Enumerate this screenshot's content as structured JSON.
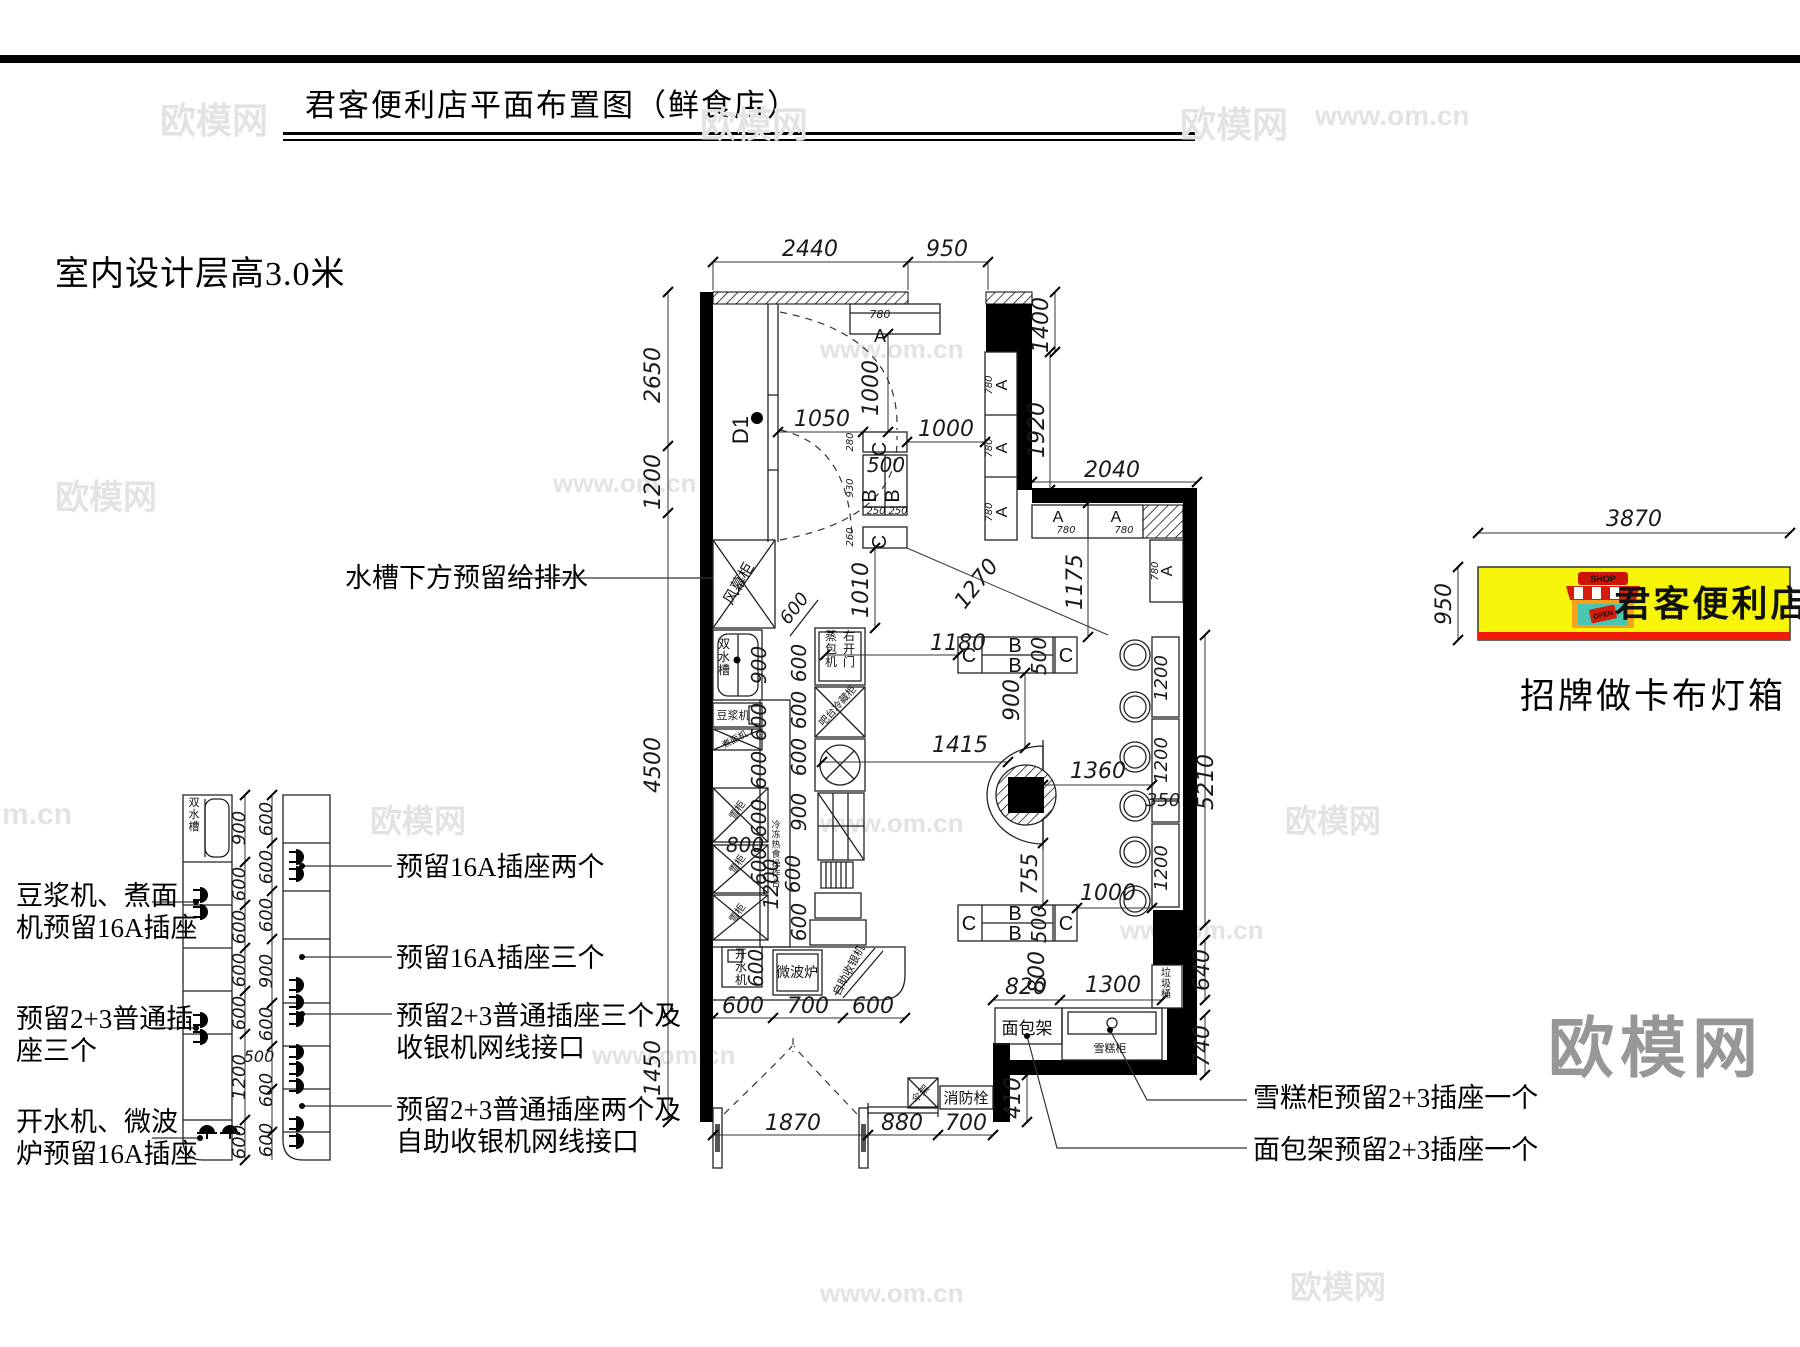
{
  "page": {
    "title": "君客便利店平面布置图（鲜食店）",
    "subtitle": "室内设计层高3.0米"
  },
  "signboard": {
    "name": "君客便利店",
    "caption": "招牌做卡布灯箱",
    "shop_sign": "SHOP",
    "open_sign": "OPEN",
    "width_dim": "3870",
    "height_dim": "950",
    "board_color": "#f6f409",
    "stripe_color": "#ee1b0b"
  },
  "big_watermark": "欧模网",
  "watermarks": [
    {
      "t": "欧模网",
      "x": 160,
      "y": 92,
      "s": 36
    },
    {
      "t": "欧模网",
      "x": 700,
      "y": 96,
      "s": 36
    },
    {
      "t": "欧模网",
      "x": 1180,
      "y": 96,
      "s": 36
    },
    {
      "t": "www.om.cn",
      "x": 1315,
      "y": 100,
      "s": 28
    },
    {
      "t": "www.om.cn",
      "x": 820,
      "y": 334,
      "s": 26
    },
    {
      "t": "www.om.cn",
      "x": 553,
      "y": 468,
      "s": 26
    },
    {
      "t": "欧模网",
      "x": 55,
      "y": 470,
      "s": 34
    },
    {
      "t": "m.cn",
      "x": 2,
      "y": 798,
      "s": 30
    },
    {
      "t": "欧模网",
      "x": 370,
      "y": 796,
      "s": 32
    },
    {
      "t": "www.om.cn",
      "x": 820,
      "y": 808,
      "s": 26
    },
    {
      "t": "欧模网",
      "x": 1285,
      "y": 796,
      "s": 32
    },
    {
      "t": "www.om.cn",
      "x": 592,
      "y": 1040,
      "s": 26
    },
    {
      "t": "www.om.cn",
      "x": 1120,
      "y": 915,
      "s": 26
    },
    {
      "t": "www.om.cn",
      "x": 820,
      "y": 1278,
      "s": 26
    },
    {
      "t": "欧模网",
      "x": 1290,
      "y": 1262,
      "s": 32
    }
  ],
  "callouts": [
    {
      "lines": [
        "水槽下方预留给排水"
      ],
      "x": 345,
      "y": 562
    },
    {
      "lines": [
        "豆浆机、煮面",
        "机预留16A插座"
      ],
      "x": 16,
      "y": 880
    },
    {
      "lines": [
        "预留2+3普通插",
        "座三个"
      ],
      "x": 16,
      "y": 1003
    },
    {
      "lines": [
        "开水机、微波",
        "炉预留16A插座"
      ],
      "x": 16,
      "y": 1106
    },
    {
      "lines": [
        "预留16A插座两个"
      ],
      "x": 396,
      "y": 851
    },
    {
      "lines": [
        "预留16A插座三个"
      ],
      "x": 396,
      "y": 942
    },
    {
      "lines": [
        "预留2+3普通插座三个及",
        "收银机网线接口"
      ],
      "x": 396,
      "y": 1000
    },
    {
      "lines": [
        "预留2+3普通插座两个及",
        "自助收银机网线接口"
      ],
      "x": 396,
      "y": 1094
    },
    {
      "lines": [
        "雪糕柜预留2+3插座一个"
      ],
      "x": 1253,
      "y": 1082
    },
    {
      "lines": [
        "面包架预留2+3插座一个"
      ],
      "x": 1253,
      "y": 1134
    }
  ],
  "plan": {
    "texts": [
      {
        "t": "2440",
        "x": 810,
        "y": 256,
        "s": 22,
        "d": 1
      },
      {
        "t": "950",
        "x": 947,
        "y": 256,
        "s": 22,
        "d": 1
      },
      {
        "t": "1400",
        "x": 1048,
        "y": 325,
        "s": 22,
        "d": 1,
        "r": -90
      },
      {
        "t": "1920",
        "x": 1044,
        "y": 430,
        "s": 22,
        "d": 1,
        "r": -90
      },
      {
        "t": "2040",
        "x": 1112,
        "y": 477,
        "s": 22,
        "d": 1
      },
      {
        "t": "2650",
        "x": 660,
        "y": 375,
        "s": 22,
        "d": 1,
        "r": -90
      },
      {
        "t": "1200",
        "x": 660,
        "y": 482,
        "s": 22,
        "d": 1,
        "r": -90
      },
      {
        "t": "4500",
        "x": 660,
        "y": 765,
        "s": 22,
        "d": 1,
        "r": -90
      },
      {
        "t": "1450",
        "x": 660,
        "y": 1068,
        "s": 22,
        "d": 1,
        "r": -90
      },
      {
        "t": "D1",
        "x": 748,
        "y": 430,
        "s": 22,
        "r": -90
      },
      {
        "t": "1050",
        "x": 822,
        "y": 426,
        "s": 22,
        "d": 1
      },
      {
        "t": "1000",
        "x": 878,
        "y": 388,
        "s": 22,
        "d": 1,
        "r": -90
      },
      {
        "t": "780",
        "x": 880,
        "y": 318,
        "s": 11,
        "d": 1
      },
      {
        "t": "A",
        "x": 880,
        "y": 342,
        "s": 18
      },
      {
        "t": "C",
        "x": 886,
        "y": 449,
        "s": 20,
        "r": -90
      },
      {
        "t": "500",
        "x": 886,
        "y": 472,
        "s": 20,
        "d": 1
      },
      {
        "t": "B",
        "x": 876,
        "y": 496,
        "s": 20,
        "r": -90
      },
      {
        "t": "B",
        "x": 899,
        "y": 496,
        "s": 20,
        "r": -90
      },
      {
        "t": "250",
        "x": 876,
        "y": 514,
        "s": 10,
        "d": 1
      },
      {
        "t": "250",
        "x": 898,
        "y": 514,
        "s": 10,
        "d": 1
      },
      {
        "t": "C",
        "x": 886,
        "y": 542,
        "s": 20,
        "r": -90
      },
      {
        "t": "280",
        "x": 853,
        "y": 442,
        "s": 10,
        "d": 1,
        "r": -90
      },
      {
        "t": "930",
        "x": 853,
        "y": 488,
        "s": 10,
        "d": 1,
        "r": -90
      },
      {
        "t": "260",
        "x": 853,
        "y": 537,
        "s": 10,
        "d": 1,
        "r": -90
      },
      {
        "t": "1000",
        "x": 946,
        "y": 436,
        "s": 22,
        "d": 1
      },
      {
        "t": "1010",
        "x": 868,
        "y": 590,
        "s": 22,
        "d": 1,
        "r": -90
      },
      {
        "t": "1270",
        "x": 982,
        "y": 588,
        "s": 22,
        "d": 1,
        "r": -52
      },
      {
        "t": "1175",
        "x": 1082,
        "y": 582,
        "s": 22,
        "d": 1,
        "r": -90
      },
      {
        "t": "780",
        "x": 992,
        "y": 385,
        "s": 10,
        "d": 1,
        "r": -90
      },
      {
        "t": "A",
        "x": 1007,
        "y": 385,
        "s": 16,
        "r": -90
      },
      {
        "t": "780",
        "x": 992,
        "y": 448,
        "s": 10,
        "d": 1,
        "r": -90
      },
      {
        "t": "A",
        "x": 1007,
        "y": 448,
        "s": 16,
        "r": -90
      },
      {
        "t": "780",
        "x": 992,
        "y": 512,
        "s": 10,
        "d": 1,
        "r": -90
      },
      {
        "t": "A",
        "x": 1007,
        "y": 512,
        "s": 16,
        "r": -90
      },
      {
        "t": "A",
        "x": 1058,
        "y": 522,
        "s": 16
      },
      {
        "t": "780",
        "x": 1066,
        "y": 533,
        "s": 10,
        "d": 1
      },
      {
        "t": "A",
        "x": 1116,
        "y": 522,
        "s": 16
      },
      {
        "t": "780",
        "x": 1124,
        "y": 533,
        "s": 10,
        "d": 1
      },
      {
        "t": "780",
        "x": 1158,
        "y": 571,
        "s": 10,
        "d": 1,
        "r": -90
      },
      {
        "t": "A",
        "x": 1172,
        "y": 571,
        "s": 16,
        "r": -90
      },
      {
        "t": "5210",
        "x": 1213,
        "y": 782,
        "s": 22,
        "d": 1,
        "r": -90
      },
      {
        "t": "风幕柜",
        "x": 743,
        "y": 586,
        "s": 15,
        "r": -60
      },
      {
        "t": "双水槽",
        "x": 724,
        "y": 648,
        "s": 12,
        "v": 1
      },
      {
        "t": "豆浆机",
        "x": 733,
        "y": 719,
        "s": 11
      },
      {
        "t": "煮面机",
        "x": 736,
        "y": 742,
        "s": 9,
        "r": -28
      },
      {
        "t": "雪柜",
        "x": 740,
        "y": 812,
        "s": 10,
        "r": -55
      },
      {
        "t": "雪柜",
        "x": 740,
        "y": 866,
        "s": 10,
        "r": -55
      },
      {
        "t": "雪柜",
        "x": 740,
        "y": 915,
        "s": 10,
        "r": -55
      },
      {
        "t": "开水机",
        "x": 741,
        "y": 958,
        "s": 12,
        "v": 1
      },
      {
        "t": "微波炉",
        "x": 797,
        "y": 977,
        "s": 14
      },
      {
        "t": "自助收银机",
        "x": 852,
        "y": 972,
        "s": 11,
        "r": -62
      },
      {
        "t": "冷冻热食操作台",
        "x": 776,
        "y": 828,
        "s": 9,
        "v": 1
      },
      {
        "t": "900",
        "x": 766,
        "y": 665,
        "s": 20,
        "d": 1,
        "r": -90
      },
      {
        "t": "600",
        "x": 766,
        "y": 722,
        "s": 20,
        "d": 1,
        "r": -90
      },
      {
        "t": "600",
        "x": 766,
        "y": 770,
        "s": 20,
        "d": 1,
        "r": -90
      },
      {
        "t": "600",
        "x": 766,
        "y": 818,
        "s": 20,
        "d": 1,
        "r": -90
      },
      {
        "t": "600",
        "x": 766,
        "y": 866,
        "s": 20,
        "d": 1,
        "r": -90
      },
      {
        "t": "600",
        "x": 806,
        "y": 663,
        "s": 20,
        "d": 1,
        "r": -90
      },
      {
        "t": "600",
        "x": 806,
        "y": 710,
        "s": 20,
        "d": 1,
        "r": -90
      },
      {
        "t": "600",
        "x": 806,
        "y": 757,
        "s": 20,
        "d": 1,
        "r": -90
      },
      {
        "t": "900",
        "x": 806,
        "y": 812,
        "s": 20,
        "d": 1,
        "r": -90
      },
      {
        "t": "800",
        "x": 745,
        "y": 852,
        "s": 20,
        "d": 1
      },
      {
        "t": "1200",
        "x": 778,
        "y": 884,
        "s": 20,
        "d": 1,
        "r": -90
      },
      {
        "t": "600",
        "x": 800,
        "y": 874,
        "s": 20,
        "d": 1,
        "r": -90
      },
      {
        "t": "600",
        "x": 806,
        "y": 922,
        "s": 20,
        "d": 1,
        "r": -90
      },
      {
        "t": "600",
        "x": 763,
        "y": 968,
        "s": 20,
        "d": 1,
        "r": -90
      },
      {
        "t": "600",
        "x": 799,
        "y": 612,
        "s": 18,
        "d": 1,
        "r": -52
      },
      {
        "t": "蒸包机",
        "x": 831,
        "y": 640,
        "s": 12,
        "v": 1
      },
      {
        "t": "右开门",
        "x": 849,
        "y": 640,
        "s": 12,
        "v": 1
      },
      {
        "t": "吧台冷藏柜",
        "x": 840,
        "y": 708,
        "s": 10,
        "r": -48
      },
      {
        "t": "600",
        "x": 743,
        "y": 1013,
        "s": 22,
        "d": 1
      },
      {
        "t": "700",
        "x": 808,
        "y": 1013,
        "s": 22,
        "d": 1
      },
      {
        "t": "600",
        "x": 873,
        "y": 1013,
        "s": 22,
        "d": 1
      },
      {
        "t": "1180",
        "x": 958,
        "y": 650,
        "s": 22,
        "d": 1
      },
      {
        "t": "C",
        "x": 969,
        "y": 662,
        "s": 20
      },
      {
        "t": "B",
        "x": 1015,
        "y": 652,
        "s": 20
      },
      {
        "t": "B",
        "x": 1015,
        "y": 672,
        "s": 20
      },
      {
        "t": "500",
        "x": 1046,
        "y": 656,
        "s": 20,
        "d": 1,
        "r": -90
      },
      {
        "t": "C",
        "x": 1066,
        "y": 662,
        "s": 20
      },
      {
        "t": "900",
        "x": 1019,
        "y": 700,
        "s": 22,
        "d": 1,
        "r": -90
      },
      {
        "t": "1360",
        "x": 1098,
        "y": 778,
        "s": 22,
        "d": 1
      },
      {
        "t": "755",
        "x": 1037,
        "y": 874,
        "s": 22,
        "d": 1,
        "r": -90
      },
      {
        "t": "1415",
        "x": 960,
        "y": 752,
        "s": 22,
        "d": 1
      },
      {
        "t": "C",
        "x": 969,
        "y": 930,
        "s": 20
      },
      {
        "t": "B",
        "x": 1015,
        "y": 920,
        "s": 20
      },
      {
        "t": "B",
        "x": 1015,
        "y": 940,
        "s": 20
      },
      {
        "t": "500",
        "x": 1046,
        "y": 924,
        "s": 20,
        "d": 1,
        "r": -90
      },
      {
        "t": "C",
        "x": 1066,
        "y": 930,
        "s": 20
      },
      {
        "t": "1000",
        "x": 1108,
        "y": 900,
        "s": 22,
        "d": 1
      },
      {
        "t": "1200",
        "x": 1167,
        "y": 678,
        "s": 18,
        "d": 1,
        "r": -90
      },
      {
        "t": "1200",
        "x": 1167,
        "y": 760,
        "s": 18,
        "d": 1,
        "r": -90
      },
      {
        "t": "350",
        "x": 1163,
        "y": 806,
        "s": 18,
        "d": 1
      },
      {
        "t": "1200",
        "x": 1167,
        "y": 868,
        "s": 18,
        "d": 1,
        "r": -90
      },
      {
        "t": "640",
        "x": 1209,
        "y": 970,
        "s": 22,
        "d": 1,
        "r": -90
      },
      {
        "t": "740",
        "x": 1209,
        "y": 1046,
        "s": 22,
        "d": 1,
        "r": -90
      },
      {
        "t": "820",
        "x": 1026,
        "y": 994,
        "s": 22,
        "d": 1
      },
      {
        "t": "800",
        "x": 1044,
        "y": 972,
        "s": 22,
        "d": 1,
        "r": -90
      },
      {
        "t": "1300",
        "x": 1113,
        "y": 992,
        "s": 22,
        "d": 1
      },
      {
        "t": "面包架",
        "x": 1027,
        "y": 1034,
        "s": 17
      },
      {
        "t": "雪糕柜",
        "x": 1110,
        "y": 1052,
        "s": 11
      },
      {
        "t": "垃圾桶",
        "x": 1166,
        "y": 976,
        "s": 10,
        "v": 1
      },
      {
        "t": "410",
        "x": 1020,
        "y": 1098,
        "s": 22,
        "d": 1,
        "r": -90
      },
      {
        "t": "伞架",
        "x": 923,
        "y": 1096,
        "s": 10,
        "r": -48
      },
      {
        "t": "消防栓",
        "x": 966,
        "y": 1103,
        "s": 15
      },
      {
        "t": "1870",
        "x": 793,
        "y": 1130,
        "s": 22,
        "d": 1
      },
      {
        "t": "880",
        "x": 902,
        "y": 1130,
        "s": 22,
        "d": 1
      },
      {
        "t": "700",
        "x": 966,
        "y": 1130,
        "s": 22,
        "d": 1
      },
      {
        "t": "双水槽",
        "x": 194,
        "y": 806,
        "s": 11,
        "v": 1
      },
      {
        "t": "900",
        "x": 245,
        "y": 828,
        "s": 18,
        "d": 1,
        "r": -90
      },
      {
        "t": "600",
        "x": 245,
        "y": 884,
        "s": 18,
        "d": 1,
        "r": -90
      },
      {
        "t": "600",
        "x": 245,
        "y": 927,
        "s": 18,
        "d": 1,
        "r": -90
      },
      {
        "t": "600",
        "x": 245,
        "y": 970,
        "s": 18,
        "d": 1,
        "r": -90
      },
      {
        "t": "600",
        "x": 245,
        "y": 1013,
        "s": 18,
        "d": 1,
        "r": -90
      },
      {
        "t": "1200",
        "x": 245,
        "y": 1077,
        "s": 18,
        "d": 1,
        "r": -90
      },
      {
        "t": "600",
        "x": 245,
        "y": 1142,
        "s": 18,
        "d": 1,
        "r": -90
      },
      {
        "t": "600",
        "x": 272,
        "y": 819,
        "s": 18,
        "d": 1,
        "r": -90
      },
      {
        "t": "600",
        "x": 272,
        "y": 867,
        "s": 18,
        "d": 1,
        "r": -90
      },
      {
        "t": "600",
        "x": 272,
        "y": 915,
        "s": 18,
        "d": 1,
        "r": -90
      },
      {
        "t": "900",
        "x": 272,
        "y": 971,
        "s": 18,
        "d": 1,
        "r": -90
      },
      {
        "t": "600",
        "x": 272,
        "y": 1024,
        "s": 18,
        "d": 1,
        "r": -90
      },
      {
        "t": "600",
        "x": 272,
        "y": 1090,
        "s": 18,
        "d": 1,
        "r": -90
      },
      {
        "t": "600",
        "x": 272,
        "y": 1140,
        "s": 18,
        "d": 1,
        "r": -90
      },
      {
        "t": "500",
        "x": 259,
        "y": 1062,
        "s": 16,
        "d": 1
      },
      {
        "t": "3870",
        "x": 1634,
        "y": 526,
        "s": 22,
        "d": 1
      },
      {
        "t": "950",
        "x": 1451,
        "y": 604,
        "s": 22,
        "d": 1,
        "r": -90
      }
    ]
  }
}
